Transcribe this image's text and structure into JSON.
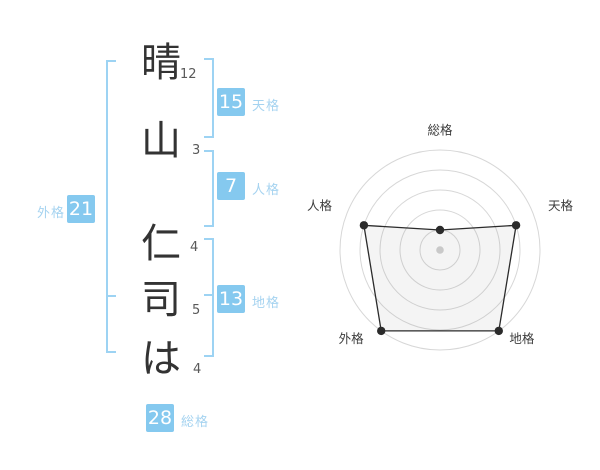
{
  "name": {
    "characters": [
      {
        "char": "晴",
        "strokes": "12"
      },
      {
        "char": "山",
        "strokes": "3"
      },
      {
        "char": "仁",
        "strokes": "4"
      },
      {
        "char": "司",
        "strokes": "5"
      },
      {
        "char": "は",
        "strokes": "4"
      }
    ]
  },
  "results": {
    "tenkaku": {
      "value": "15",
      "label": "天格"
    },
    "jinkaku": {
      "value": "7",
      "label": "人格"
    },
    "chikaku": {
      "value": "13",
      "label": "地格"
    },
    "gaikaku": {
      "value": "21",
      "label": "外格"
    },
    "soukaku": {
      "value": "28",
      "label": "総格"
    }
  },
  "colors": {
    "accent_box": "#85C9EF",
    "accent_label": "#A5D3F0",
    "bracket": "#9DD3F3",
    "name_text": "#333333",
    "stroke_text": "#595959",
    "ring": "#D7D7D7",
    "polygon_stroke": "#2B2B2B",
    "polygon_fill": "rgba(130,130,130,0.09)",
    "center_dot": "#C9C9C9",
    "chart_label": "#3D3D3D"
  },
  "chart_data": {
    "type": "radar",
    "axes": [
      "総格",
      "天格",
      "地格",
      "外格",
      "人格"
    ],
    "values": [
      1,
      4,
      5,
      5,
      4
    ],
    "max": 5,
    "rings": 5,
    "grid": "concentric-circles",
    "legend": false,
    "title": ""
  }
}
